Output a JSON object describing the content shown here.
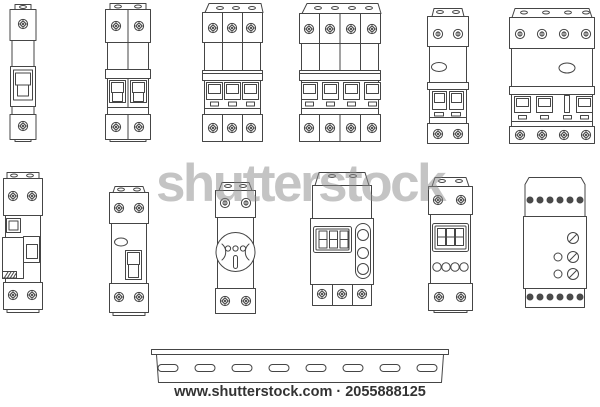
{
  "watermark": {
    "text": "shutterstock",
    "color": "#8a8a8a"
  },
  "footer": {
    "text": "www.shutterstock.com · 2055888125",
    "site": "www.shutterstock.com",
    "image_id": "2055888125"
  },
  "illustration": {
    "line_color": "#454545",
    "background": "#ffffff",
    "devices_row1": [
      "single-pole-circuit-breaker",
      "double-pole-circuit-breaker",
      "triple-pole-circuit-breaker",
      "four-pole-circuit-breaker",
      "double-pole-breaker-with-indicator",
      "four-pole-breaker-with-indicator"
    ],
    "devices_row2": [
      "rcbo-residual-breaker",
      "rcd-switch",
      "din-rail-power-socket",
      "digital-timer-relay",
      "digital-time-switch",
      "multifunction-relay-module"
    ],
    "din_rail": {
      "name": "din-mounting-rail",
      "slot_count": 8
    }
  }
}
